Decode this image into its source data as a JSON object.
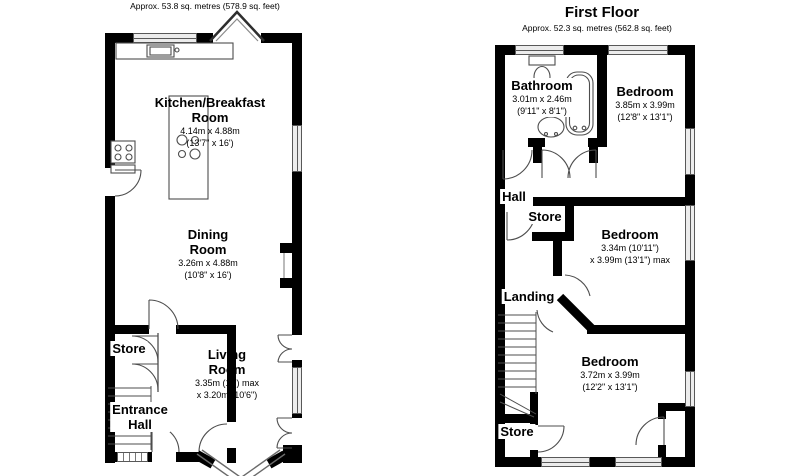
{
  "ground_floor": {
    "subtitle": "Approx. 53.8 sq. metres (578.9 sq. feet)",
    "rooms": {
      "kitchen": {
        "name_line1": "Kitchen/Breakfast",
        "name_line2": "Room",
        "dim_line1": "4.14m x 4.88m",
        "dim_line2": "(13'7\" x 16')"
      },
      "dining": {
        "name_line1": "Dining",
        "name_line2": "Room",
        "dim_line1": "3.26m x 4.88m",
        "dim_line2": "(10'8\" x 16')"
      },
      "store": {
        "name": "Store"
      },
      "living": {
        "name_line1": "Living",
        "name_line2": "Room",
        "dim_line1": "3.35m (11') max",
        "dim_line2": "x 3.20m (10'6\")"
      },
      "entrance_hall": {
        "name_line1": "Entrance",
        "name_line2": "Hall"
      }
    }
  },
  "first_floor": {
    "title": "First Floor",
    "subtitle": "Approx. 52.3 sq. metres (562.8 sq. feet)",
    "rooms": {
      "bathroom": {
        "name": "Bathroom",
        "dim_line1": "3.01m x 2.46m",
        "dim_line2": "(9'11\" x 8'1\")"
      },
      "bedroom_front": {
        "name": "Bedroom",
        "dim_line1": "3.85m x 3.99m",
        "dim_line2": "(12'8\" x 13'1\")"
      },
      "hall": {
        "name": "Hall"
      },
      "store_upper": {
        "name": "Store"
      },
      "bedroom_middle": {
        "name": "Bedroom",
        "dim_line1": "3.34m (10'11\")",
        "dim_line2": "x 3.99m (13'1\") max"
      },
      "landing": {
        "name": "Landing"
      },
      "bedroom_rear": {
        "name": "Bedroom",
        "dim_line1": "3.72m x 3.99m",
        "dim_line2": "(12'2\" x 13'1\")"
      },
      "store_lower": {
        "name": "Store"
      }
    }
  },
  "colors": {
    "wall": "#000000",
    "window_fill": "#ececec",
    "detail_line": "#4d4d4d",
    "background": "#ffffff"
  }
}
